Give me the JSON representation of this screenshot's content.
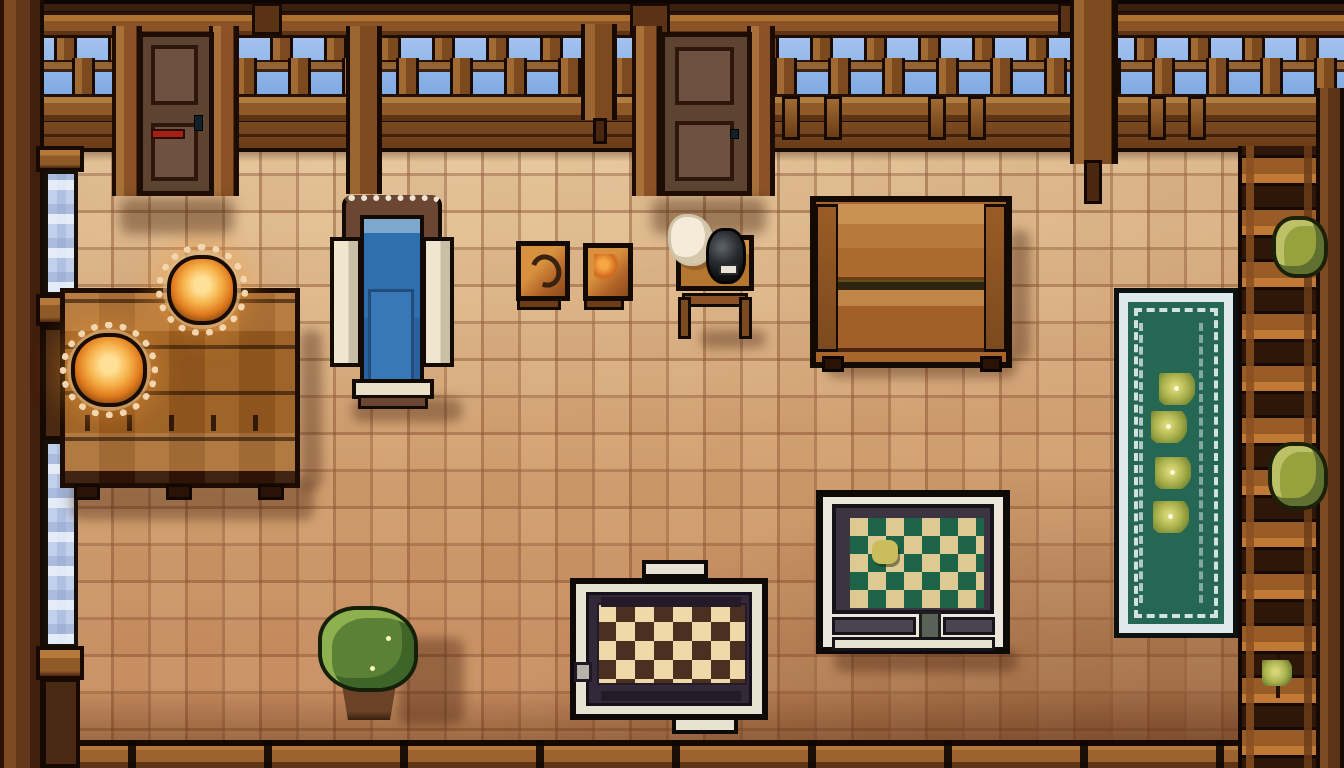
{
  "scene": {
    "title": "Pixel-art cottage interior (top-down)",
    "style": "pixel-art game screenshot, no on-screen text or HUD",
    "palette": {
      "outline": "#150a03",
      "wood_dark": "#2e1708",
      "wood": "#8a5527",
      "wood_light": "#c08648",
      "sky": "#8cb4e8",
      "window_glass": "#b9c8e8",
      "floor_light": "#d8b28c",
      "floor_deep": "#c2865a",
      "grout": "#7a4828",
      "chair_blue": "#2e6fb0",
      "cream": "#e9e0c9",
      "flame": "#f6b24a",
      "latch_red": "#a32014",
      "board_green": "#1d6347",
      "board_cream": "#dfc992",
      "checker_dark": "#4a3020",
      "checker_cream": "#efd9a8",
      "rug_green": "#256753",
      "rug_trim": "#dfe8ea",
      "plant_green": "#5b8136",
      "bush_olive": "#97a23f"
    },
    "objects": {
      "floor": {
        "label": "terracotta tile floor"
      },
      "top_wall": {
        "label": "wooden balcony wall with balustrade and sky gaps"
      },
      "door_left": {
        "label": "wooden door with red latch"
      },
      "door_center": {
        "label": "wooden two-panel door"
      },
      "left_wall": {
        "label": "left wall with two tall blue windows"
      },
      "window_upper": {
        "label": "tall window, upper left"
      },
      "window_lower": {
        "label": "tall window, lower left"
      },
      "dining_table": {
        "label": "large wooden plank table"
      },
      "lamp_1": {
        "label": "glowing candle lamp on doily"
      },
      "lamp_2": {
        "label": "glowing candle lamp on doily"
      },
      "armchair": {
        "label": "blue armchair with cream armrests"
      },
      "crate_1": {
        "label": "small framed crate with dark swirl"
      },
      "crate_2": {
        "label": "small framed crate with embers"
      },
      "side_table": {
        "label": "small wooden side table"
      },
      "kettle": {
        "label": "black kettle pot"
      },
      "sack": {
        "label": "white cloth bundle"
      },
      "bench": {
        "label": "long wooden bench"
      },
      "game_board": {
        "label": "game table with green diamond board",
        "piece_count": 1
      },
      "checkered_rug": {
        "label": "cream and brown checkered mat"
      },
      "potted_plant": {
        "label": "leafy potted plant"
      },
      "green_rug": {
        "label": "green runner rug with flower clusters",
        "flower_count": 4
      },
      "right_shelf": {
        "label": "wooden ladder shelf"
      },
      "bush_upper": {
        "label": "olive bush on shelf"
      },
      "bush_lower": {
        "label": "olive bush on shelf"
      },
      "corner_flower": {
        "label": "small corner flower"
      },
      "bottom_wall": {
        "label": "bottom wooden wall plate"
      }
    }
  }
}
